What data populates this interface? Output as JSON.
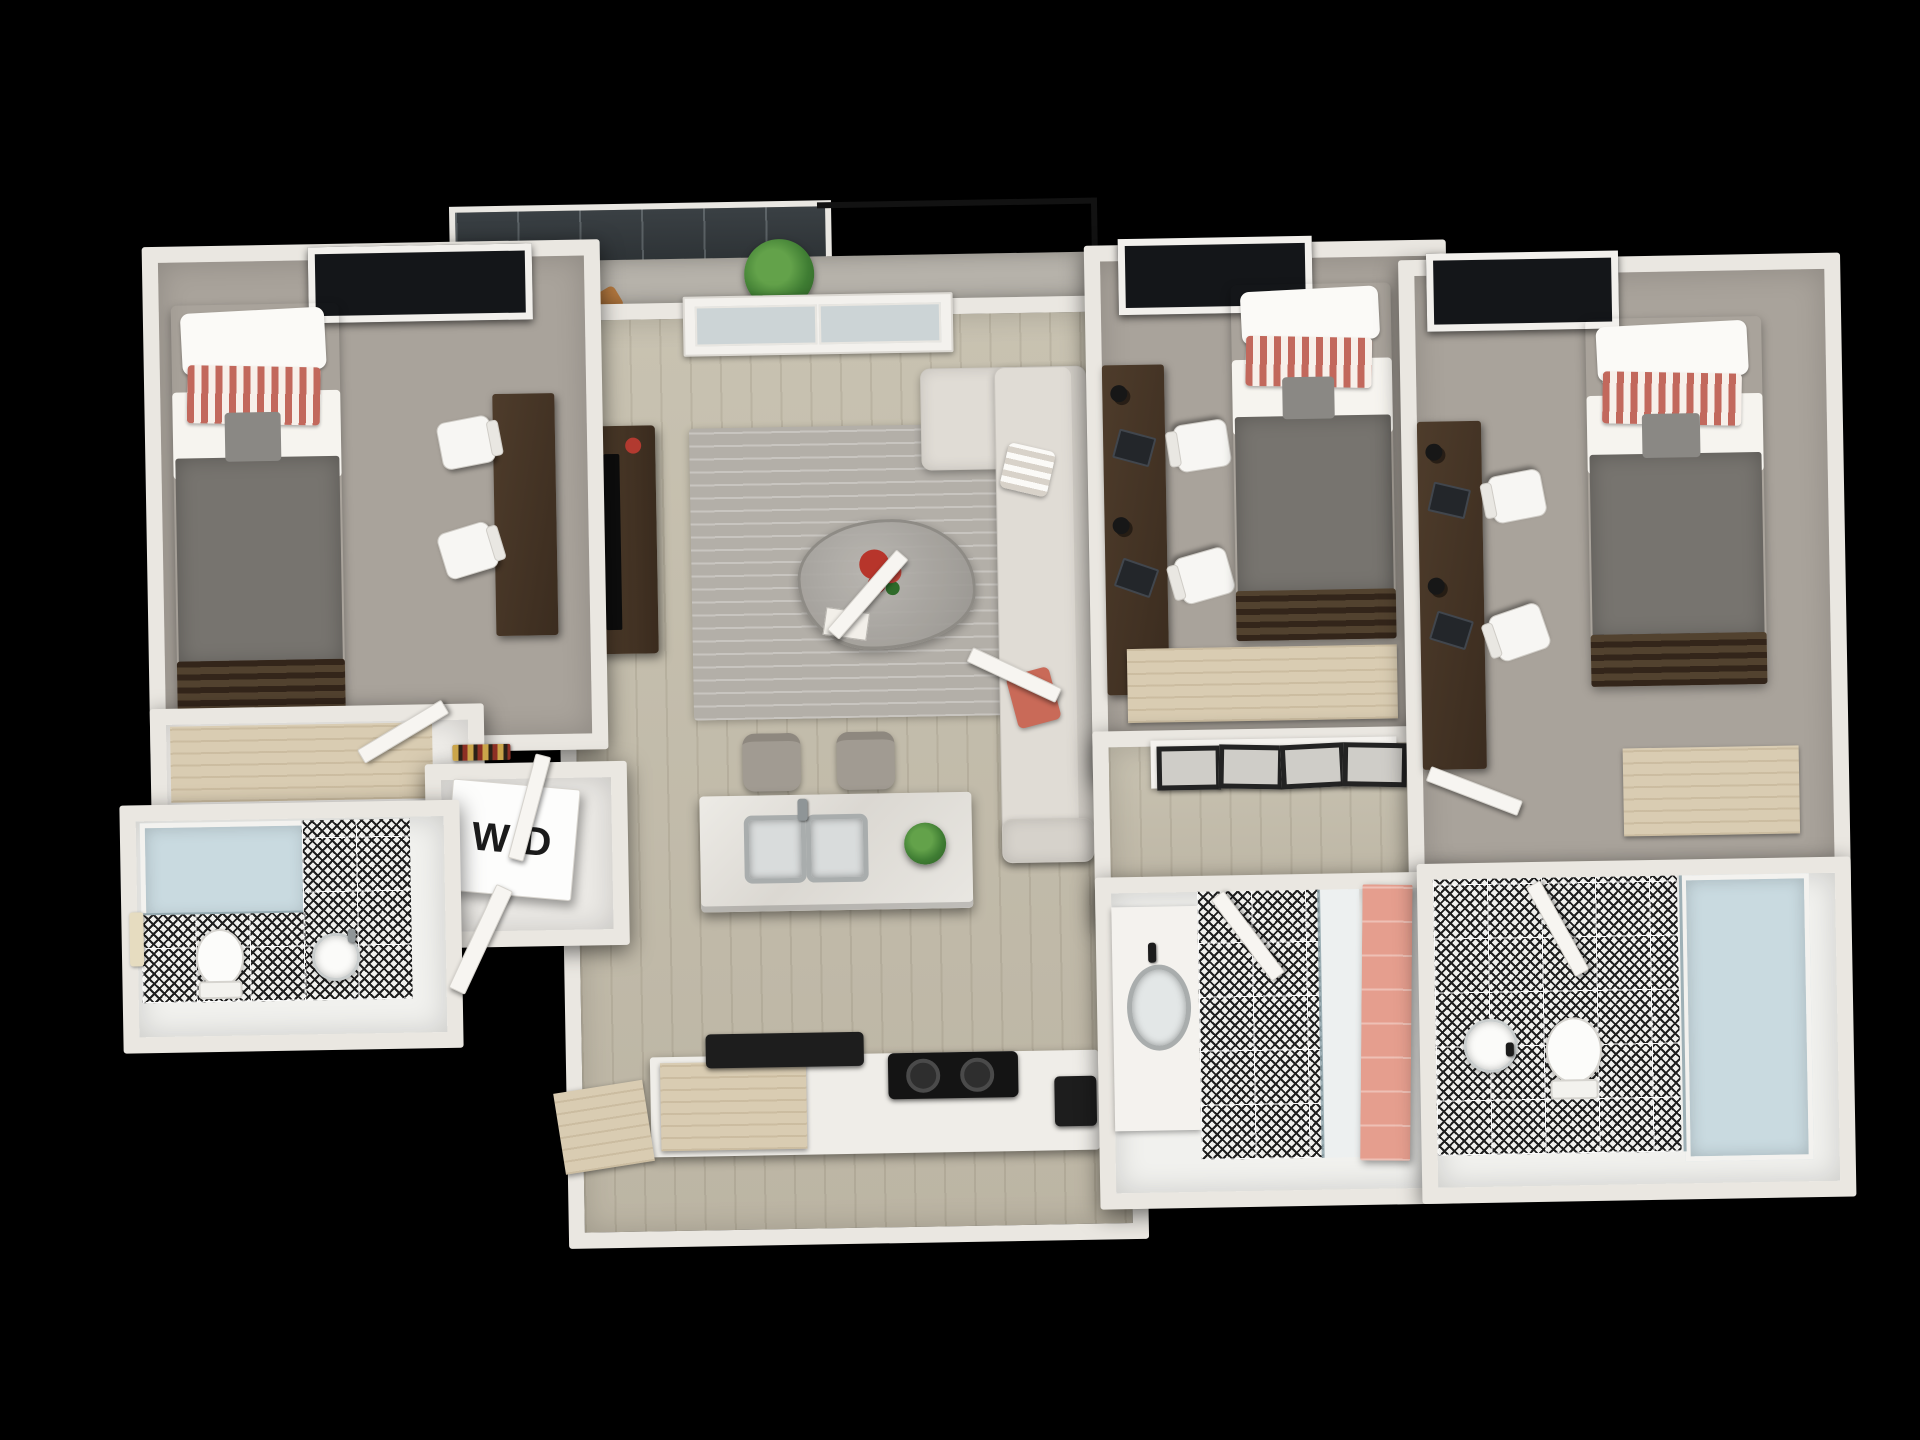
{
  "scene": {
    "description": "3D top-down rendered floor plan of a three-bedroom / three-bathroom apartment with open living-kitchen area, balcony and in-unit laundry closet, on a black background",
    "view": "isometric top-down 3D render"
  },
  "labels": {
    "washer_dryer": "W/D"
  },
  "rooms": [
    "bedroom-1",
    "bedroom-2",
    "bedroom-3",
    "bathroom-1",
    "bathroom-2",
    "bathroom-3",
    "living-room",
    "kitchen",
    "hallway",
    "balcony",
    "laundry-closet"
  ],
  "palette": {
    "bg": "#000000",
    "wall": "#eae7e1",
    "carpet": "#a9a39b",
    "wood": "#c8c2b1",
    "wooddark": "#bcb5a4",
    "tilebase": "#f1f1ee",
    "tileink": "#1f1f1f",
    "blanket": "#77746f",
    "pillowred": "#c2685c",
    "sofa": "#e0dcd5",
    "rug": "#b3afa8",
    "counter": "#efede8",
    "tan": "#d9ccb2",
    "showerblue": "#c9dae0",
    "pink": "#e59e8e",
    "plantgreen": "#3f7d33",
    "door": "#f7f5f1",
    "coral": "#c96a58"
  }
}
